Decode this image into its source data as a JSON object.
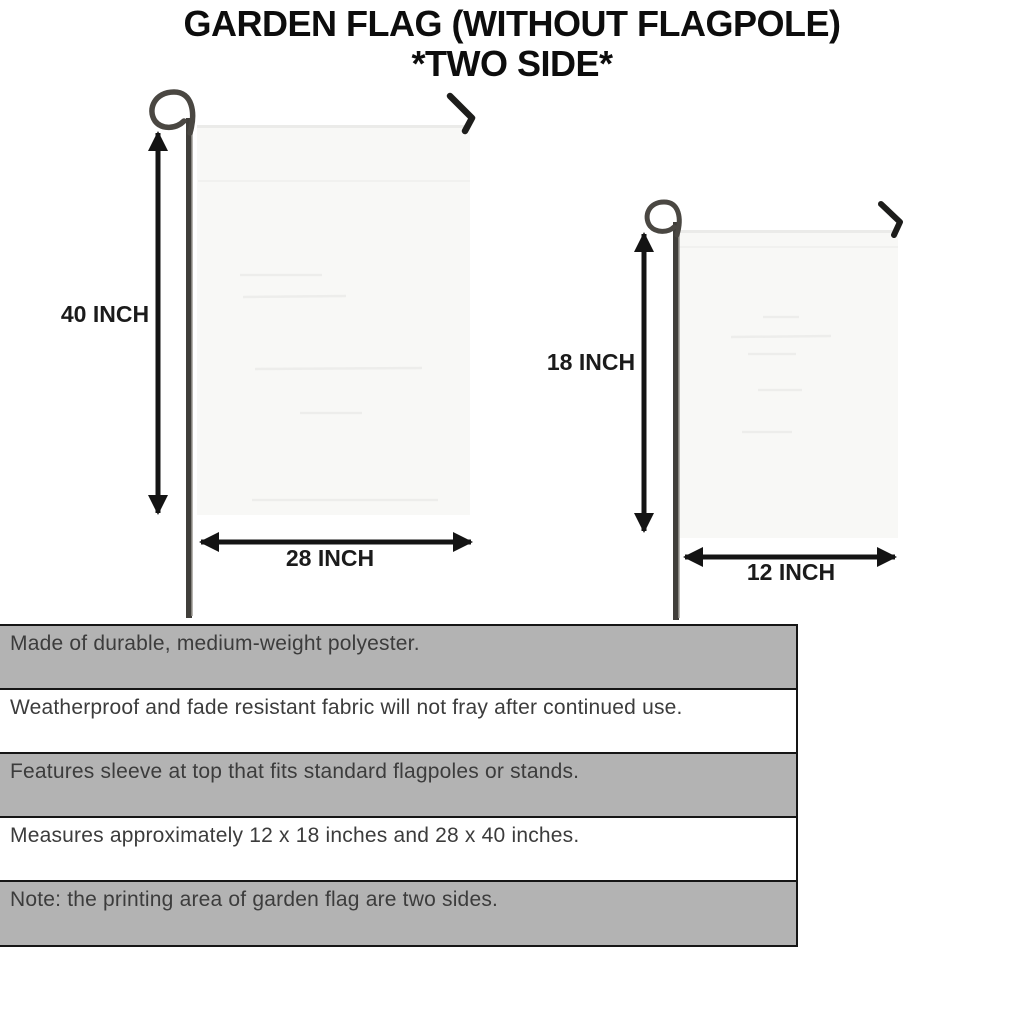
{
  "title": {
    "line1": "GARDEN FLAG (WITHOUT FLAGPOLE)",
    "line2": "*TWO SIDE*"
  },
  "flags": {
    "large": {
      "height_label": "40 INCH",
      "width_label": "28 INCH"
    },
    "small": {
      "height_label": "18 INCH",
      "width_label": "12 INCH"
    }
  },
  "features": [
    "Made of durable, medium-weight polyester.",
    "Weatherproof and fade resistant fabric will not fray after continued use.",
    "Features sleeve at top that fits standard flagpoles or stands.",
    "Measures approximately 12 x 18 inches and 28 x 40 inches.",
    "Note: the printing area of garden flag are two sides."
  ],
  "colors": {
    "stripe_gray": "#b3b3b3",
    "stripe_white": "#ffffff",
    "table_border": "#161616",
    "arrow_black": "#141414",
    "flag_fill": "#f8f8f6",
    "pole_dark": "#403e3a",
    "feature_text": "#3c3c3c",
    "title_text": "#0d0d0d"
  }
}
